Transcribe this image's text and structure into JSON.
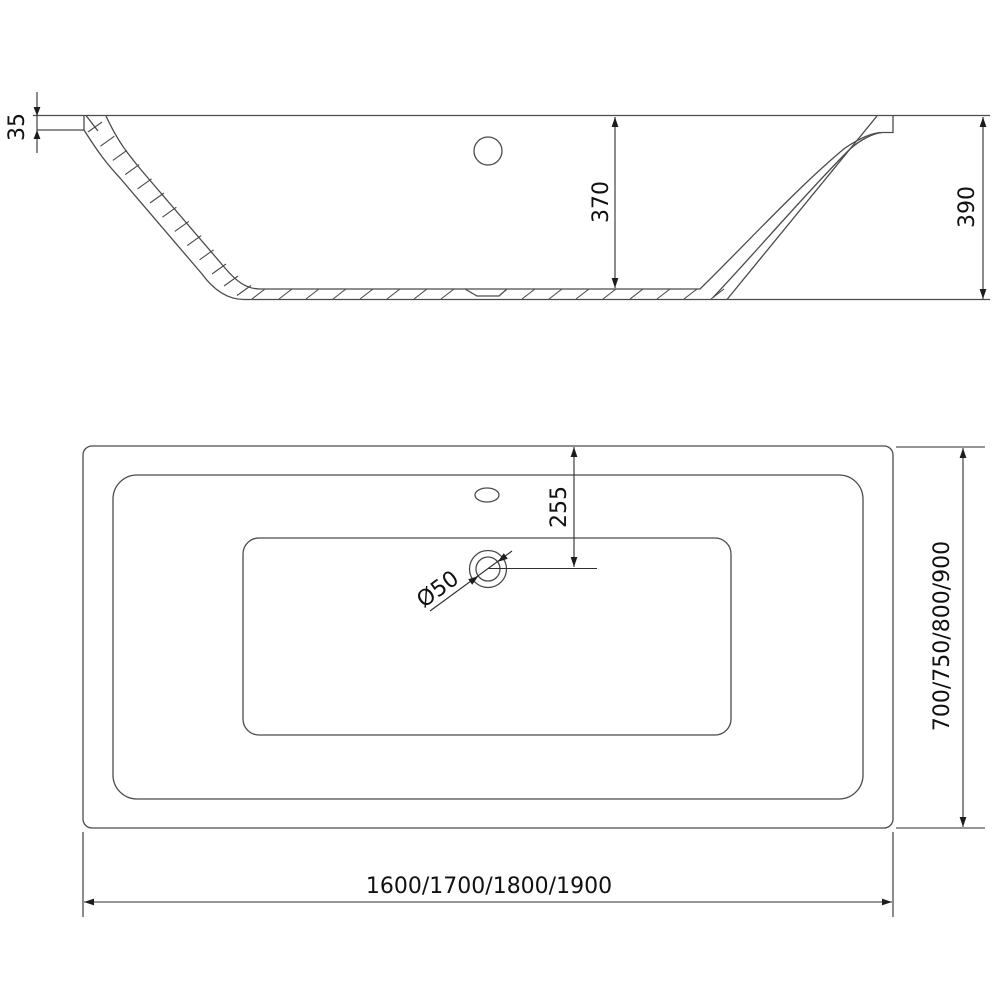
{
  "drawing": {
    "type": "bathtub-technical-drawing",
    "views": {
      "section": "cross-section side view",
      "plan": "top plan view"
    }
  },
  "dimensions": {
    "rim_thickness": "35",
    "inner_depth": "370",
    "total_height": "390",
    "drain_center_offset": "255",
    "drain_diameter": "Ø50",
    "width_options": "700/750/800/900",
    "length_options": "1600/1700/1800/1900"
  },
  "colors": {
    "background": "#ffffff",
    "model_line": "#4b4b4b",
    "dimension_line": "#2e2e2e",
    "text": "#111111"
  }
}
